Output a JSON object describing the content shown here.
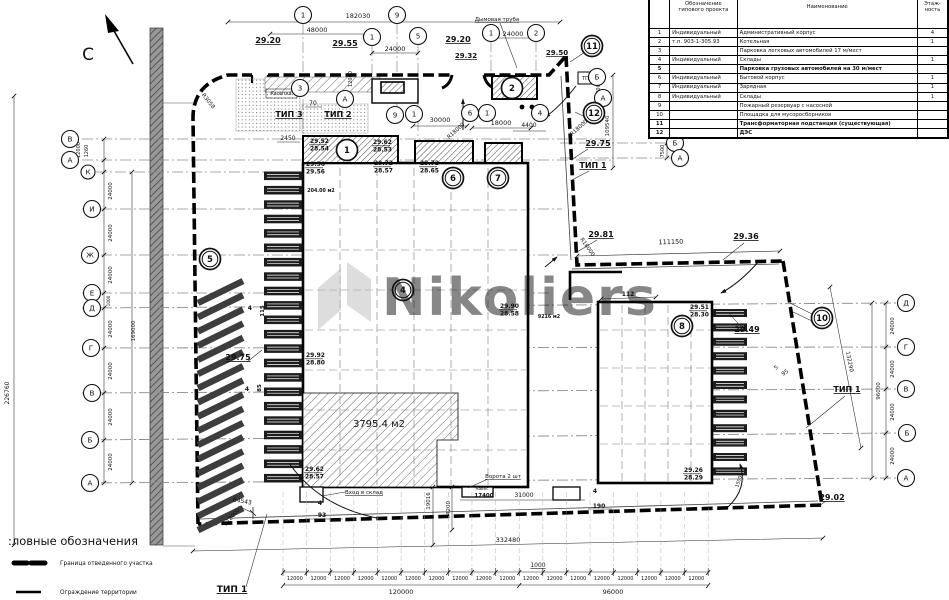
{
  "colors": {
    "paper": "#ffffff",
    "ink": "#111111",
    "watermark": "#bcbcbc",
    "axis_line": "#8a8a8a",
    "road_fill": "#989898",
    "hatch": "#4a4a4a"
  },
  "watermark": {
    "text": "Nikoliers"
  },
  "north": {
    "label": "С"
  },
  "legend": {
    "title": ":ловные обозначения",
    "items": [
      {
        "label": "Граница отведенного участка"
      },
      {
        "label": "Ограждение территории"
      }
    ]
  },
  "table": {
    "headers": {
      "num": "",
      "designation": "Обозначение типового проекта",
      "name": "Наименование",
      "floors": "Этаж- ность"
    },
    "rows": [
      {
        "num": "1",
        "designation": "Индивидуальный",
        "name": "Административный корпус",
        "floors": "4",
        "bold": false
      },
      {
        "num": "2",
        "designation": "т.п. 903-1-305.93",
        "name": "Котельная",
        "floors": "1",
        "bold": false
      },
      {
        "num": "3",
        "designation": "",
        "name": "Парковка легковых автомобилей 17 м/мест",
        "floors": "",
        "bold": false
      },
      {
        "num": "4",
        "designation": "Индивидуальный",
        "name": "Склады",
        "floors": "1",
        "bold": false
      },
      {
        "num": "5",
        "designation": "",
        "name": "Парковка грузовых автомобилей на 30 м/мест",
        "floors": "",
        "bold": true
      },
      {
        "num": "6",
        "designation": "Индивидуальный",
        "name": "Бытовой корпус",
        "floors": "1",
        "bold": false
      },
      {
        "num": "7",
        "designation": "Индивидуальный",
        "name": "Зарядная",
        "floors": "1",
        "bold": false
      },
      {
        "num": "8",
        "designation": "Индивидуальный",
        "name": "Склады",
        "floors": "1",
        "bold": false
      },
      {
        "num": "9",
        "designation": "",
        "name": "Пожарный резервуар с насосной",
        "floors": "",
        "bold": false
      },
      {
        "num": "10",
        "designation": "",
        "name": "Площадка для мусоросборников",
        "floors": "",
        "bold": false
      },
      {
        "num": "11",
        "designation": "",
        "name": "Трансформаторная подстанция (существующая)",
        "floors": "",
        "bold": true
      },
      {
        "num": "12",
        "designation": "",
        "name": "ДЭС",
        "floors": "",
        "bold": true
      }
    ]
  },
  "drawing": {
    "area_labels": [
      "204.00 м2",
      "3795.4 м2",
      "9216 м2"
    ],
    "bottom_chain": {
      "x0": 283,
      "y_label": 580,
      "step": 23.62,
      "count": 18,
      "seg_label": "12000"
    },
    "annotations": [
      {
        "t": "182030",
        "x": 358,
        "y": 18
      },
      {
        "t": "48000",
        "x": 317,
        "y": 32
      },
      {
        "t": "24000",
        "x": 395,
        "y": 51
      },
      {
        "t": "24000",
        "x": 513,
        "y": 36
      },
      {
        "t": "Дымовая труба",
        "x": 497,
        "y": 21,
        "s": 5.5,
        "u": 1
      },
      {
        "t": "29.20",
        "x": 268,
        "y": 43,
        "s": 8,
        "u": 1,
        "b": 1
      },
      {
        "t": "29.55",
        "x": 345,
        "y": 46,
        "s": 8,
        "u": 1,
        "b": 1
      },
      {
        "t": "29.20",
        "x": 458,
        "y": 42,
        "s": 8,
        "u": 1,
        "b": 1
      },
      {
        "t": "29.32",
        "x": 466,
        "y": 58,
        "s": 7,
        "u": 1,
        "b": 1
      },
      {
        "t": "29.50",
        "x": 557,
        "y": 55,
        "s": 7,
        "u": 1,
        "b": 1
      },
      {
        "t": "ТИП 3",
        "x": 289,
        "y": 117,
        "s": 8,
        "b": 1,
        "u": 1
      },
      {
        "t": "ТИП 2",
        "x": 338,
        "y": 117,
        "s": 8,
        "b": 1,
        "u": 1
      },
      {
        "t": "Калитка",
        "x": 281,
        "y": 95,
        "s": 4.8
      },
      {
        "t": "70",
        "x": 313,
        "y": 105,
        "s": 6
      },
      {
        "t": "2450",
        "x": 288,
        "y": 140,
        "s": 6
      },
      {
        "t": "30000",
        "x": 440,
        "y": 122
      },
      {
        "t": "18000",
        "x": 501,
        "y": 125
      },
      {
        "t": "4400",
        "x": 529,
        "y": 127,
        "s": 6
      },
      {
        "t": "R18000",
        "x": 457,
        "y": 132,
        "s": 5.5,
        "r": -42
      },
      {
        "t": "R18000",
        "x": 580,
        "y": 129,
        "s": 5.5,
        "r": -42
      },
      {
        "t": "R3058",
        "x": 207,
        "y": 102,
        "s": 5.5,
        "r": 52
      },
      {
        "t": "ТП",
        "x": 585.5,
        "y": 80,
        "s": 5
      },
      {
        "t": "12000",
        "x": 80,
        "y": 150,
        "s": 5,
        "r": -90
      },
      {
        "t": "1260",
        "x": 88,
        "y": 151,
        "s": 5,
        "r": -90
      },
      {
        "t": "12000",
        "x": 352,
        "y": 79,
        "s": 5,
        "r": -90
      },
      {
        "t": "12000",
        "x": 600,
        "y": 89,
        "s": 5,
        "r": -90
      },
      {
        "t": "109540",
        "x": 609,
        "y": 126,
        "s": 5.5,
        "r": -90
      },
      {
        "t": "7500",
        "x": 664,
        "y": 151,
        "s": 5,
        "r": -90
      },
      {
        "t": "29.75",
        "x": 598,
        "y": 146,
        "s": 8,
        "u": 1,
        "b": 1
      },
      {
        "t": "ТИП 1",
        "x": 593,
        "y": 168,
        "s": 8,
        "b": 1,
        "u": 1
      },
      {
        "t": "29.81",
        "x": 601,
        "y": 237,
        "s": 8,
        "u": 1,
        "b": 1
      },
      {
        "t": "111150",
        "x": 671,
        "y": 244,
        "r": -2
      },
      {
        "t": "29.36",
        "x": 746,
        "y": 239,
        "s": 8,
        "u": 1,
        "b": 1
      },
      {
        "t": "112",
        "x": 628,
        "y": 296,
        "s": 6,
        "b": 1
      },
      {
        "t": "R18000",
        "x": 586,
        "y": 248,
        "s": 5.5,
        "r": 55
      },
      {
        "t": "204.00 м2",
        "x": 321,
        "y": 192,
        "s": 4.8,
        "b": 1
      },
      {
        "t": "9216 м2",
        "x": 549,
        "y": 318,
        "s": 4.8,
        "b": 1
      },
      {
        "t": "29.49",
        "x": 747,
        "y": 332,
        "s": 8,
        "u": 1,
        "b": 1
      },
      {
        "t": "132290",
        "x": 848,
        "y": 362,
        "s": 5.5,
        "r": 79
      },
      {
        "t": "ТИП 1",
        "x": 847,
        "y": 392,
        "s": 8,
        "b": 1,
        "u": 1
      },
      {
        "t": "5",
        "x": 777,
        "y": 369,
        "s": 5.5,
        "r": -35
      },
      {
        "t": "95",
        "x": 786,
        "y": 374,
        "s": 5.5,
        "r": -35
      },
      {
        "t": "29.75",
        "x": 238,
        "y": 360,
        "s": 8,
        "u": 1,
        "b": 1
      },
      {
        "t": "115",
        "x": 264,
        "y": 311,
        "s": 5.5,
        "r": -90,
        "b": 1
      },
      {
        "t": "4",
        "x": 250,
        "y": 310,
        "s": 6,
        "b": 1
      },
      {
        "t": "85",
        "x": 261,
        "y": 388,
        "s": 5.5,
        "r": -90,
        "b": 1
      },
      {
        "t": "4",
        "x": 247,
        "y": 391,
        "s": 6,
        "b": 1
      },
      {
        "t": "3795.4 м2",
        "x": 379,
        "y": 427,
        "s": 10
      },
      {
        "t": "Вход в склад",
        "x": 364,
        "y": 494,
        "s": 5.5,
        "u": 1
      },
      {
        "t": "Ворота 2 шт",
        "x": 503,
        "y": 478,
        "s": 5.5,
        "u": 1
      },
      {
        "t": "Навес",
        "x": 482,
        "y": 490,
        "s": 4.2
      },
      {
        "t": "19016",
        "x": 430,
        "y": 501,
        "s": 5.5,
        "r": -90
      },
      {
        "t": "4200",
        "x": 450,
        "y": 508,
        "s": 5.5,
        "r": -90
      },
      {
        "t": "17400",
        "x": 484,
        "y": 497,
        "s": 5.5,
        "b": 1
      },
      {
        "t": "31000",
        "x": 524,
        "y": 497,
        "s": 6
      },
      {
        "t": "4",
        "x": 320,
        "y": 505,
        "s": 6,
        "b": 1
      },
      {
        "t": "93",
        "x": 322,
        "y": 517,
        "s": 6,
        "b": 1
      },
      {
        "t": "4",
        "x": 595,
        "y": 493,
        "s": 6,
        "b": 1
      },
      {
        "t": "190",
        "x": 599,
        "y": 508,
        "s": 6,
        "b": 1
      },
      {
        "t": "64543",
        "x": 242,
        "y": 503,
        "s": 6,
        "r": 10
      },
      {
        "t": "R18000",
        "x": 233,
        "y": 518,
        "s": 5.5,
        "r": -50
      },
      {
        "t": "29.02",
        "x": 832,
        "y": 500,
        "s": 8,
        "u": 1,
        "b": 1
      },
      {
        "t": "1500",
        "x": 740,
        "y": 482,
        "s": 4.8,
        "r": -72
      },
      {
        "t": "332480",
        "x": 508,
        "y": 542,
        "s": 6.5
      },
      {
        "t": "1000",
        "x": 538,
        "y": 567,
        "s": 6,
        "u": 1
      },
      {
        "t": "120000",
        "x": 401,
        "y": 594,
        "s": 6.5
      },
      {
        "t": "96000",
        "x": 613,
        "y": 594,
        "s": 6.5
      },
      {
        "t": "226760",
        "x": 9,
        "y": 393,
        "s": 6,
        "r": -90
      },
      {
        "t": "169000",
        "x": 135,
        "y": 331,
        "s": 5.5,
        "r": -90
      },
      {
        "t": "24000",
        "x": 112,
        "y": 191,
        "s": 5.5,
        "r": -90
      },
      {
        "t": "24000",
        "x": 112,
        "y": 233,
        "s": 5.5,
        "r": -90
      },
      {
        "t": "24000",
        "x": 112,
        "y": 275,
        "s": 5.5,
        "r": -90
      },
      {
        "t": "1000",
        "x": 110,
        "y": 301,
        "s": 4.2,
        "r": -90
      },
      {
        "t": "24000",
        "x": 112,
        "y": 329,
        "s": 5.5,
        "r": -90
      },
      {
        "t": "24000",
        "x": 112,
        "y": 371,
        "s": 5.5,
        "r": -90
      },
      {
        "t": "24000",
        "x": 112,
        "y": 417,
        "s": 5.5,
        "r": -90
      },
      {
        "t": "24000",
        "x": 112,
        "y": 462,
        "s": 5.5,
        "r": -90
      },
      {
        "t": "24000",
        "x": 894,
        "y": 326,
        "s": 5.5,
        "r": -90
      },
      {
        "t": "24000",
        "x": 894,
        "y": 369,
        "s": 5.5,
        "r": -90
      },
      {
        "t": "24000",
        "x": 894,
        "y": 412,
        "s": 5.5,
        "r": -90
      },
      {
        "t": "24000",
        "x": 894,
        "y": 456,
        "s": 5.5,
        "r": -90
      },
      {
        "t": "96000",
        "x": 880,
        "y": 391,
        "s": 5.5,
        "r": -90
      },
      {
        "t": "ТИП 1",
        "x": 232,
        "y": 592,
        "s": 9,
        "b": 1,
        "u": 1
      }
    ],
    "elevation_pairs": [
      {
        "a": "29.52",
        "b": "28.54",
        "x": 310,
        "y": 138
      },
      {
        "a": "29.62",
        "b": "28.53",
        "x": 373,
        "y": 139
      },
      {
        "a": "29.56",
        "b": "29.56",
        "x": 306,
        "y": 161
      },
      {
        "a": "29.72",
        "b": "28.57",
        "x": 374,
        "y": 160
      },
      {
        "a": "29.72",
        "b": "28.65",
        "x": 420,
        "y": 160
      },
      {
        "a": "29.92",
        "b": "28.80",
        "x": 306,
        "y": 352
      },
      {
        "a": "29.90",
        "b": "28.58",
        "x": 500,
        "y": 303
      },
      {
        "a": "29.62",
        "b": "28.57",
        "x": 305,
        "y": 466
      },
      {
        "a": "29.51",
        "b": "28.30",
        "x": 690,
        "y": 304
      },
      {
        "a": "29.26",
        "b": "28.29",
        "x": 684,
        "y": 467
      }
    ],
    "axis_circles": [
      {
        "l": "1",
        "x": 303,
        "y": 15
      },
      {
        "l": "9",
        "x": 397,
        "y": 15
      },
      {
        "l": "1",
        "x": 372,
        "y": 37
      },
      {
        "l": "5",
        "x": 418,
        "y": 36
      },
      {
        "l": "1",
        "x": 491,
        "y": 33
      },
      {
        "l": "2",
        "x": 536,
        "y": 33
      },
      {
        "l": "3",
        "x": 300,
        "y": 88
      },
      {
        "l": "А",
        "x": 345,
        "y": 99
      },
      {
        "l": "Б",
        "x": 597,
        "y": 77
      },
      {
        "l": "А",
        "x": 603,
        "y": 98
      },
      {
        "l": "Б",
        "x": 675,
        "y": 143
      },
      {
        "l": "А",
        "x": 680,
        "y": 158
      },
      {
        "l": "9",
        "x": 395,
        "y": 115
      },
      {
        "l": "1",
        "x": 414,
        "y": 114
      },
      {
        "l": "6",
        "x": 470,
        "y": 113
      },
      {
        "l": "1",
        "x": 487,
        "y": 113
      },
      {
        "l": "4",
        "x": 540,
        "y": 113
      },
      {
        "l": "В",
        "x": 70,
        "y": 139
      },
      {
        "l": "А",
        "x": 70,
        "y": 160
      },
      {
        "l": "К",
        "x": 88,
        "y": 172,
        "r": 7
      },
      {
        "l": "И",
        "x": 92,
        "y": 209
      },
      {
        "l": "Ж",
        "x": 90,
        "y": 255
      },
      {
        "l": "Е",
        "x": 92,
        "y": 293
      },
      {
        "l": "Д",
        "x": 92,
        "y": 308
      },
      {
        "l": "Г",
        "x": 91,
        "y": 348
      },
      {
        "l": "В",
        "x": 92,
        "y": 393
      },
      {
        "l": "Б",
        "x": 90,
        "y": 440
      },
      {
        "l": "А",
        "x": 90,
        "y": 483
      },
      {
        "l": "Д",
        "x": 906,
        "y": 303
      },
      {
        "l": "Г",
        "x": 906,
        "y": 347
      },
      {
        "l": "В",
        "x": 906,
        "y": 389
      },
      {
        "l": "Б",
        "x": 907,
        "y": 433
      },
      {
        "l": "А",
        "x": 906,
        "y": 478
      }
    ],
    "building_circles": [
      {
        "l": "1",
        "x": 347,
        "y": 150
      },
      {
        "l": "2",
        "x": 512,
        "y": 88
      },
      {
        "l": "6",
        "x": 453,
        "y": 178,
        "d": 1
      },
      {
        "l": "7",
        "x": 498,
        "y": 178,
        "d": 1
      },
      {
        "l": "5",
        "x": 210,
        "y": 259,
        "d": 1
      },
      {
        "l": "4",
        "x": 403,
        "y": 290,
        "d": 1
      },
      {
        "l": "8",
        "x": 682,
        "y": 326,
        "d": 1
      },
      {
        "l": "10",
        "x": 822,
        "y": 318,
        "d": 1
      },
      {
        "l": "11",
        "x": 592,
        "y": 46,
        "d": 1
      },
      {
        "l": "12",
        "x": 594,
        "y": 113,
        "d": 1
      }
    ]
  }
}
